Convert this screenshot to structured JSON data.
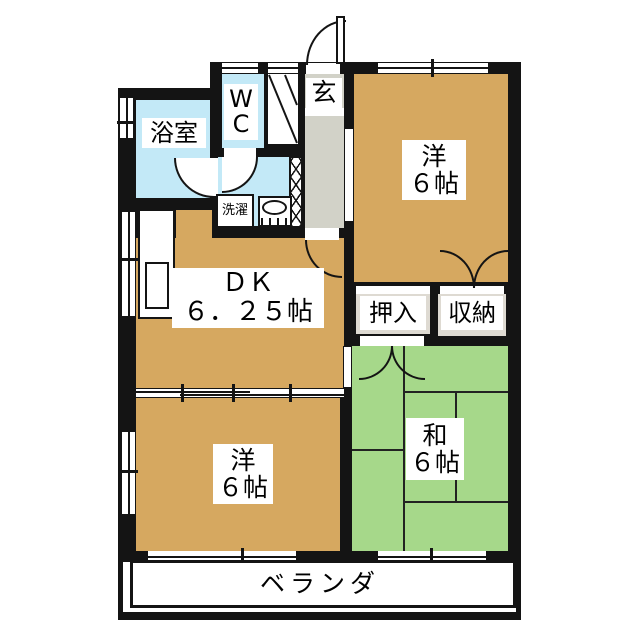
{
  "plan_title": "2DK apartment floor plan",
  "rooms": {
    "bathroom": {
      "label": "浴室"
    },
    "wc": {
      "line1": "W",
      "line2": "C"
    },
    "entrance": {
      "label": "玄"
    },
    "laundry": {
      "label": "洗濯"
    },
    "western_top": {
      "line1": "洋",
      "line2": "６帖"
    },
    "dk": {
      "line1": "ＤＫ",
      "line2": "６．２５帖"
    },
    "oshiire": {
      "label": "押入"
    },
    "shuno": {
      "label": "収納"
    },
    "washitsu": {
      "line1": "和",
      "line2": "６帖"
    },
    "western_bottom": {
      "line1": "洋",
      "line2": "６帖"
    },
    "veranda": {
      "label": "ベランダ"
    }
  },
  "colors": {
    "wall": "#141414",
    "western_room_floor": "#d6a860",
    "tatami_floor": "#a6d88a",
    "wet_area_floor": "#c3e9f7",
    "hallway_floor": "#d2d2c8",
    "closet_fill": "#dedad2",
    "background": "#ffffff"
  }
}
